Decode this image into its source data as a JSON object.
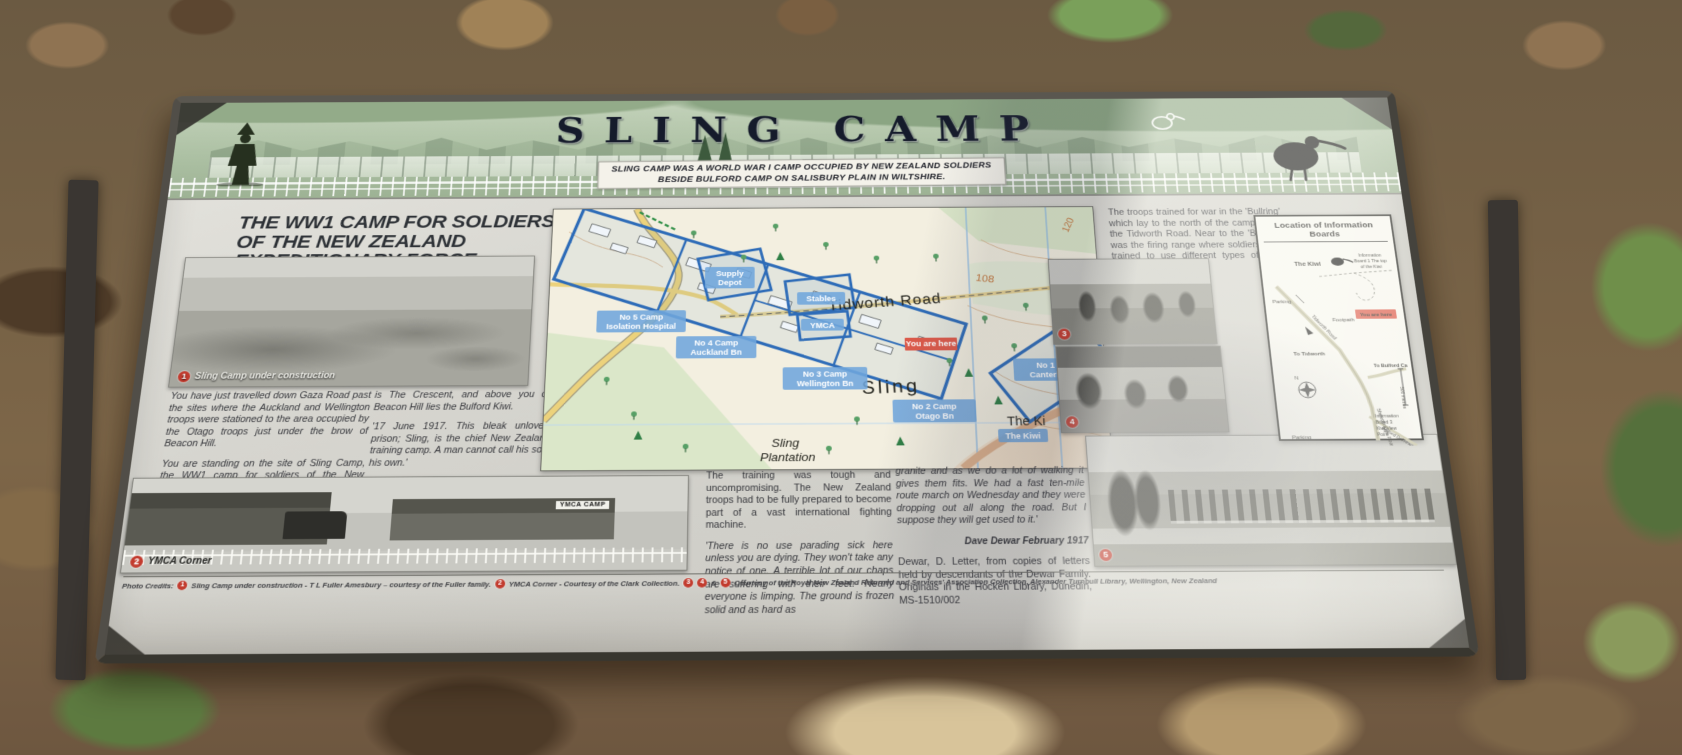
{
  "banner": {
    "title": "SLING CAMP",
    "subtitle_line1": "SLING CAMP WAS A WORLD WAR I CAMP OCCUPIED BY NEW ZEALAND SOLDIERS",
    "subtitle_line2": "BESIDE BULFORD CAMP ON SALISBURY PLAIN IN WILTSHIRE."
  },
  "left_section": {
    "heading_line1": "THE WW1 CAMP FOR SOLDIERS",
    "heading_line2": "OF THE NEW ZEALAND",
    "heading_line3": "EXPEDITIONARY FORCE",
    "photo1_caption": "Sling Camp under construction",
    "col1_para1": "You have just travelled down Gaza Road past the sites where the Auckland and Wellington troops were stationed to the area occupied by the Otago troops just under the brow of Beacon Hill.",
    "col1_para2": "You are standing on the site of Sling Camp, the WW1 camp for soldiers of the New Zealand Expeditionary Force (NZEF). Tens of thousands of New Zealand troops lived and trained here before going to fight in France. Across the road",
    "col2_para1": "is The Crescent, and above you on Beacon Hill lies the Bulford Kiwi.",
    "col2_quote": "'17 June 1917. This bleak unlovely prison; Sling, is the chief New Zealand training camp. A man cannot call his soul his own.'",
    "col2_ref": "Ingram, N M (2006). In Flanders Fields: The World War One Diary of Private Monty Ingram, Auckland: David Ling Ltd."
  },
  "map": {
    "road_label": "Tidworth Road",
    "place_sling": "Sling",
    "plantation_line1": "Sling",
    "plantation_line2": "Plantation",
    "place_kiwi": "The Ki",
    "contour_108": "108",
    "contour_120": "120",
    "you_are_here": "You are here",
    "labels": {
      "supply": [
        "Supply",
        "Depot"
      ],
      "stables": [
        "Stables"
      ],
      "ymca": [
        "YMCA"
      ],
      "camp5": [
        "No 5 Camp",
        "Isolation Hospital"
      ],
      "camp4": [
        "No 4 Camp",
        "Auckland Bn"
      ],
      "camp3": [
        "No 3 Camp",
        "Wellington Bn"
      ],
      "camp2": [
        "No 2 Camp",
        "Otago Bn"
      ],
      "camp1": [
        "No 1 Camp",
        "Canterbury Bn"
      ],
      "kiwi": [
        "The Kiwi"
      ]
    }
  },
  "right_section": {
    "para": "The troops trained for war in the 'Bullring' which lay to the north of the camp along the Tidworth Road. Near to the 'Bullring' was the firing range where soldiers were trained to use different types of guns proficiently."
  },
  "location_panel": {
    "title": "Location of Information Boards",
    "the_kiwi": "The Kiwi",
    "board1_line1": "Information",
    "board1_line2": "Board 1 The top",
    "board1_line3": "of the Kiwi",
    "parking_top": "Parking",
    "footpath": "Footpath",
    "to_tidworth": "To Tidworth",
    "tidworth_road": "Tidworth Road",
    "you_are_here": "You are here",
    "to_bulford": "To Bulford Camp",
    "sheepbridge_road": "Sheepbridge Road",
    "droveway": "Bulford Droveway",
    "board3_line1": "Information",
    "board3_line2": "Board 3",
    "board3_line3": "Kiwi View",
    "board3_line4": "Point",
    "parking_bottom": "Parking",
    "scale": "500 metres",
    "compass_n": "N"
  },
  "bottom": {
    "photo2_caption": "YMCA Corner",
    "photo2_sign": "YMCA CAMP",
    "mid_para": "The training was tough and uncompromising. The New Zealand troops had to be fully prepared to become part of a vast international fighting machine.",
    "mid_quote": "'There is no use parading sick here unless you are dying. They won't take any notice of one. A terrible lot of our chaps are suffering with their feet. Nearly everyone is limping. The ground is frozen solid and as hard as",
    "right_quote": "granite and as we do a lot of walking it gives them fits. We had a fast ten-mile route march on Wednesday and they were dropping out all along the road. But I suppose they will get used to it.'",
    "attribution": "Dave Dewar February 1917",
    "right_ref": "Dewar, D. Letter, from copies of letters held by descendants of the Dewar Family. Originals in the Hocken Library, Dunedin, MS-1510/002"
  },
  "badges": {
    "b1": "1",
    "b2": "2",
    "b3": "3",
    "b4": "4",
    "b5": "5"
  },
  "credits": {
    "prefix": "Photo Credits:",
    "item1": "Sling Camp under construction - T L Fuller Amesbury – courtesy of the Fuller family.",
    "item2": "YMCA Corner - Courtesy of the Clark Collection.",
    "amp": "&",
    "item345": "Courtesy of the Royal New Zealand Returned and Services' Association Collection, Alexander Turnbull Library, Wellington, New Zealand"
  },
  "colors": {
    "overlay_blue": "#2e6cb8",
    "label_blue": "#6fa6dc",
    "you_are_here_red": "#dd5a4a",
    "badge_red": "#c23b2e",
    "map_cream": "#f3efe0",
    "woodland_green": "#dbe7c9",
    "road_yellow": "#ecd27c",
    "banner_green": "#adc1a4"
  }
}
